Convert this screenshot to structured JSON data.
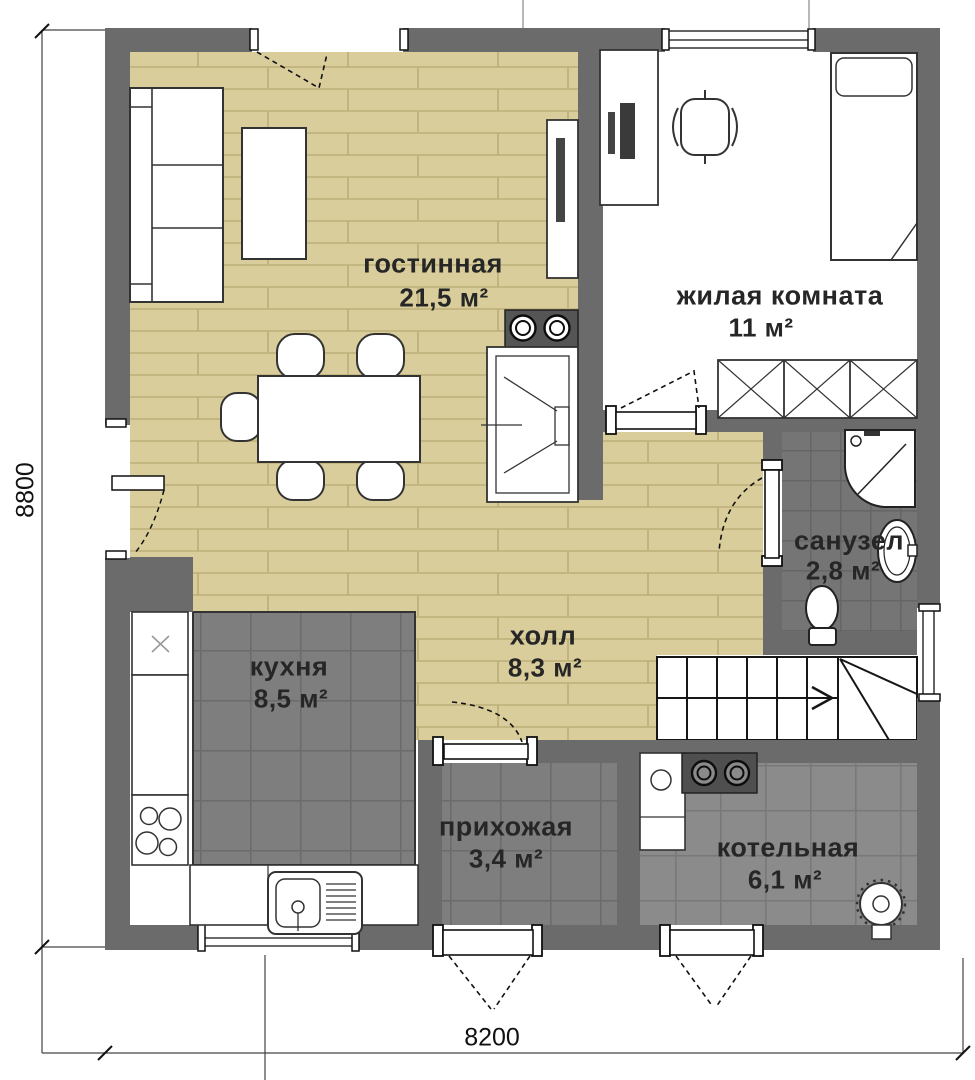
{
  "rooms": [
    {
      "id": "living",
      "name": "гостинная",
      "area": "21,5 м²"
    },
    {
      "id": "bedroom",
      "name": "жилая комната",
      "area": "11 м²"
    },
    {
      "id": "bathroom",
      "name": "санузел",
      "area": "2,8 м²"
    },
    {
      "id": "hall",
      "name": "холл",
      "area": "8,3 м²"
    },
    {
      "id": "kitchen",
      "name": "кухня",
      "area": "8,5 м²"
    },
    {
      "id": "entry",
      "name": "прихожая",
      "area": "3,4 м²"
    },
    {
      "id": "boiler",
      "name": "котельная",
      "area": "6,1 м²"
    }
  ],
  "dimensions": {
    "width_label": "8200",
    "height_label": "8800"
  },
  "colors": {
    "wall": "#6b6b6b",
    "wood_floor": "#d9cd9b",
    "tile_dark": "#7e7e7e",
    "tile_bath": "#757575",
    "tile_boiler": "#8b8b8b",
    "line": "#1a1a1a"
  },
  "fixtures": [
    "sofa",
    "coffee-table",
    "tv-stand",
    "dining-table",
    "dining-chair",
    "fireplace",
    "computer-desk",
    "office-chair",
    "bed",
    "wardrobe",
    "shower-cabin",
    "washbasin",
    "toilet",
    "staircase",
    "fridge",
    "stove",
    "kitchen-sink",
    "kitchen-counter",
    "boiler-unit",
    "entrance-door",
    "interior-door",
    "window"
  ]
}
